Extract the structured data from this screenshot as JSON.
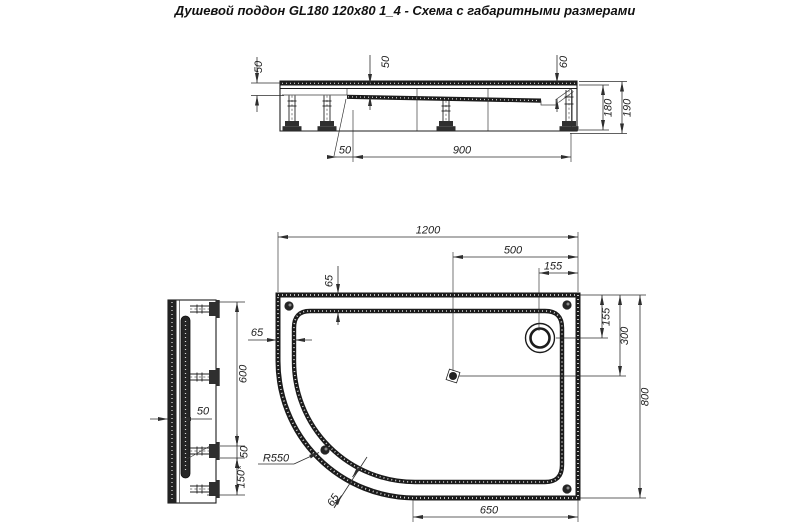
{
  "title": "Душевой поддон GL180 120x80 1_4 - Схема с габаритными размерами",
  "colors": {
    "background": "#ffffff",
    "line": "#1b1b1b",
    "dimension": "#2e2e2e"
  },
  "views": {
    "front": {
      "label": "front-section-view",
      "dims": {
        "rim_height": "50",
        "basin_depth": "50",
        "drain_depth": "60",
        "body_height": "180",
        "total_height": "190",
        "leg_inset": "50",
        "leg_span": "900"
      }
    },
    "side": {
      "label": "side-section-view",
      "dims": {
        "edge_offset": "50",
        "upper_length": "600",
        "gap": "50",
        "lower_length": "150*"
      }
    },
    "plan": {
      "label": "plan-view",
      "dims": {
        "width": "1200",
        "drain_to_edge": "500",
        "drain_offset_x": "155",
        "rim_top": "65",
        "rim_left": "65",
        "drain_offset_y": "155",
        "center_offset": "300",
        "depth": "800",
        "bottom_edge": "650",
        "corner_radius": "R550",
        "rim_arc": "65"
      }
    }
  }
}
